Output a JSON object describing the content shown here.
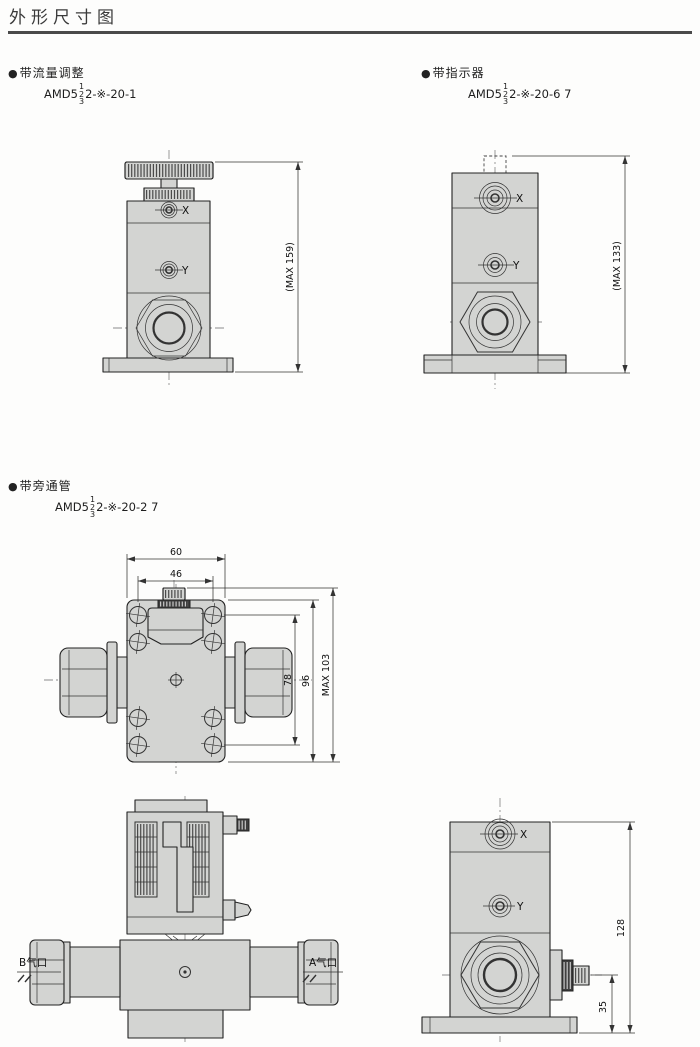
{
  "page": {
    "title": "外形尺寸图"
  },
  "sections": {
    "flow": {
      "bullet": "●",
      "label": "带流量调整",
      "model": {
        "prefix": "AMD5",
        "stack": [
          "1",
          "2",
          "3"
        ],
        "suffix": "2-※-20-1"
      }
    },
    "indicator": {
      "bullet": "●",
      "label": "带指示器",
      "model": {
        "prefix": "AMD5",
        "stack": [
          "1",
          "2",
          "3"
        ],
        "suffix": "2-※-20-6 7"
      }
    },
    "bypass": {
      "bullet": "●",
      "label": "带旁通管",
      "model": {
        "prefix": "AMD5",
        "stack": [
          "1",
          "2",
          "3"
        ],
        "suffix": "2-※-20-2 7"
      }
    }
  },
  "drawings": {
    "flow_front": {
      "dim_max_height": "(MAX 159)",
      "port_x": "X",
      "port_y": "Y"
    },
    "indicator_front": {
      "dim_max_height": "(MAX 133)",
      "port_x": "X",
      "port_y": "Y"
    },
    "bypass_top": {
      "dim_width_outer": "60",
      "dim_width_inner": "46",
      "dim_height_holes": "78",
      "dim_height_body": "96",
      "dim_height_max": "MAX 103"
    },
    "bypass_section": {
      "port_b": "B气口",
      "port_a": "A气口"
    },
    "bypass_side": {
      "dim_total_height": "128",
      "dim_knob_height": "35",
      "port_x": "X",
      "port_y": "Y"
    }
  },
  "colors": {
    "body_fill": "#d3d4d2",
    "line": "#222222",
    "dim": "#333333",
    "rule": "#4a4a4a"
  }
}
